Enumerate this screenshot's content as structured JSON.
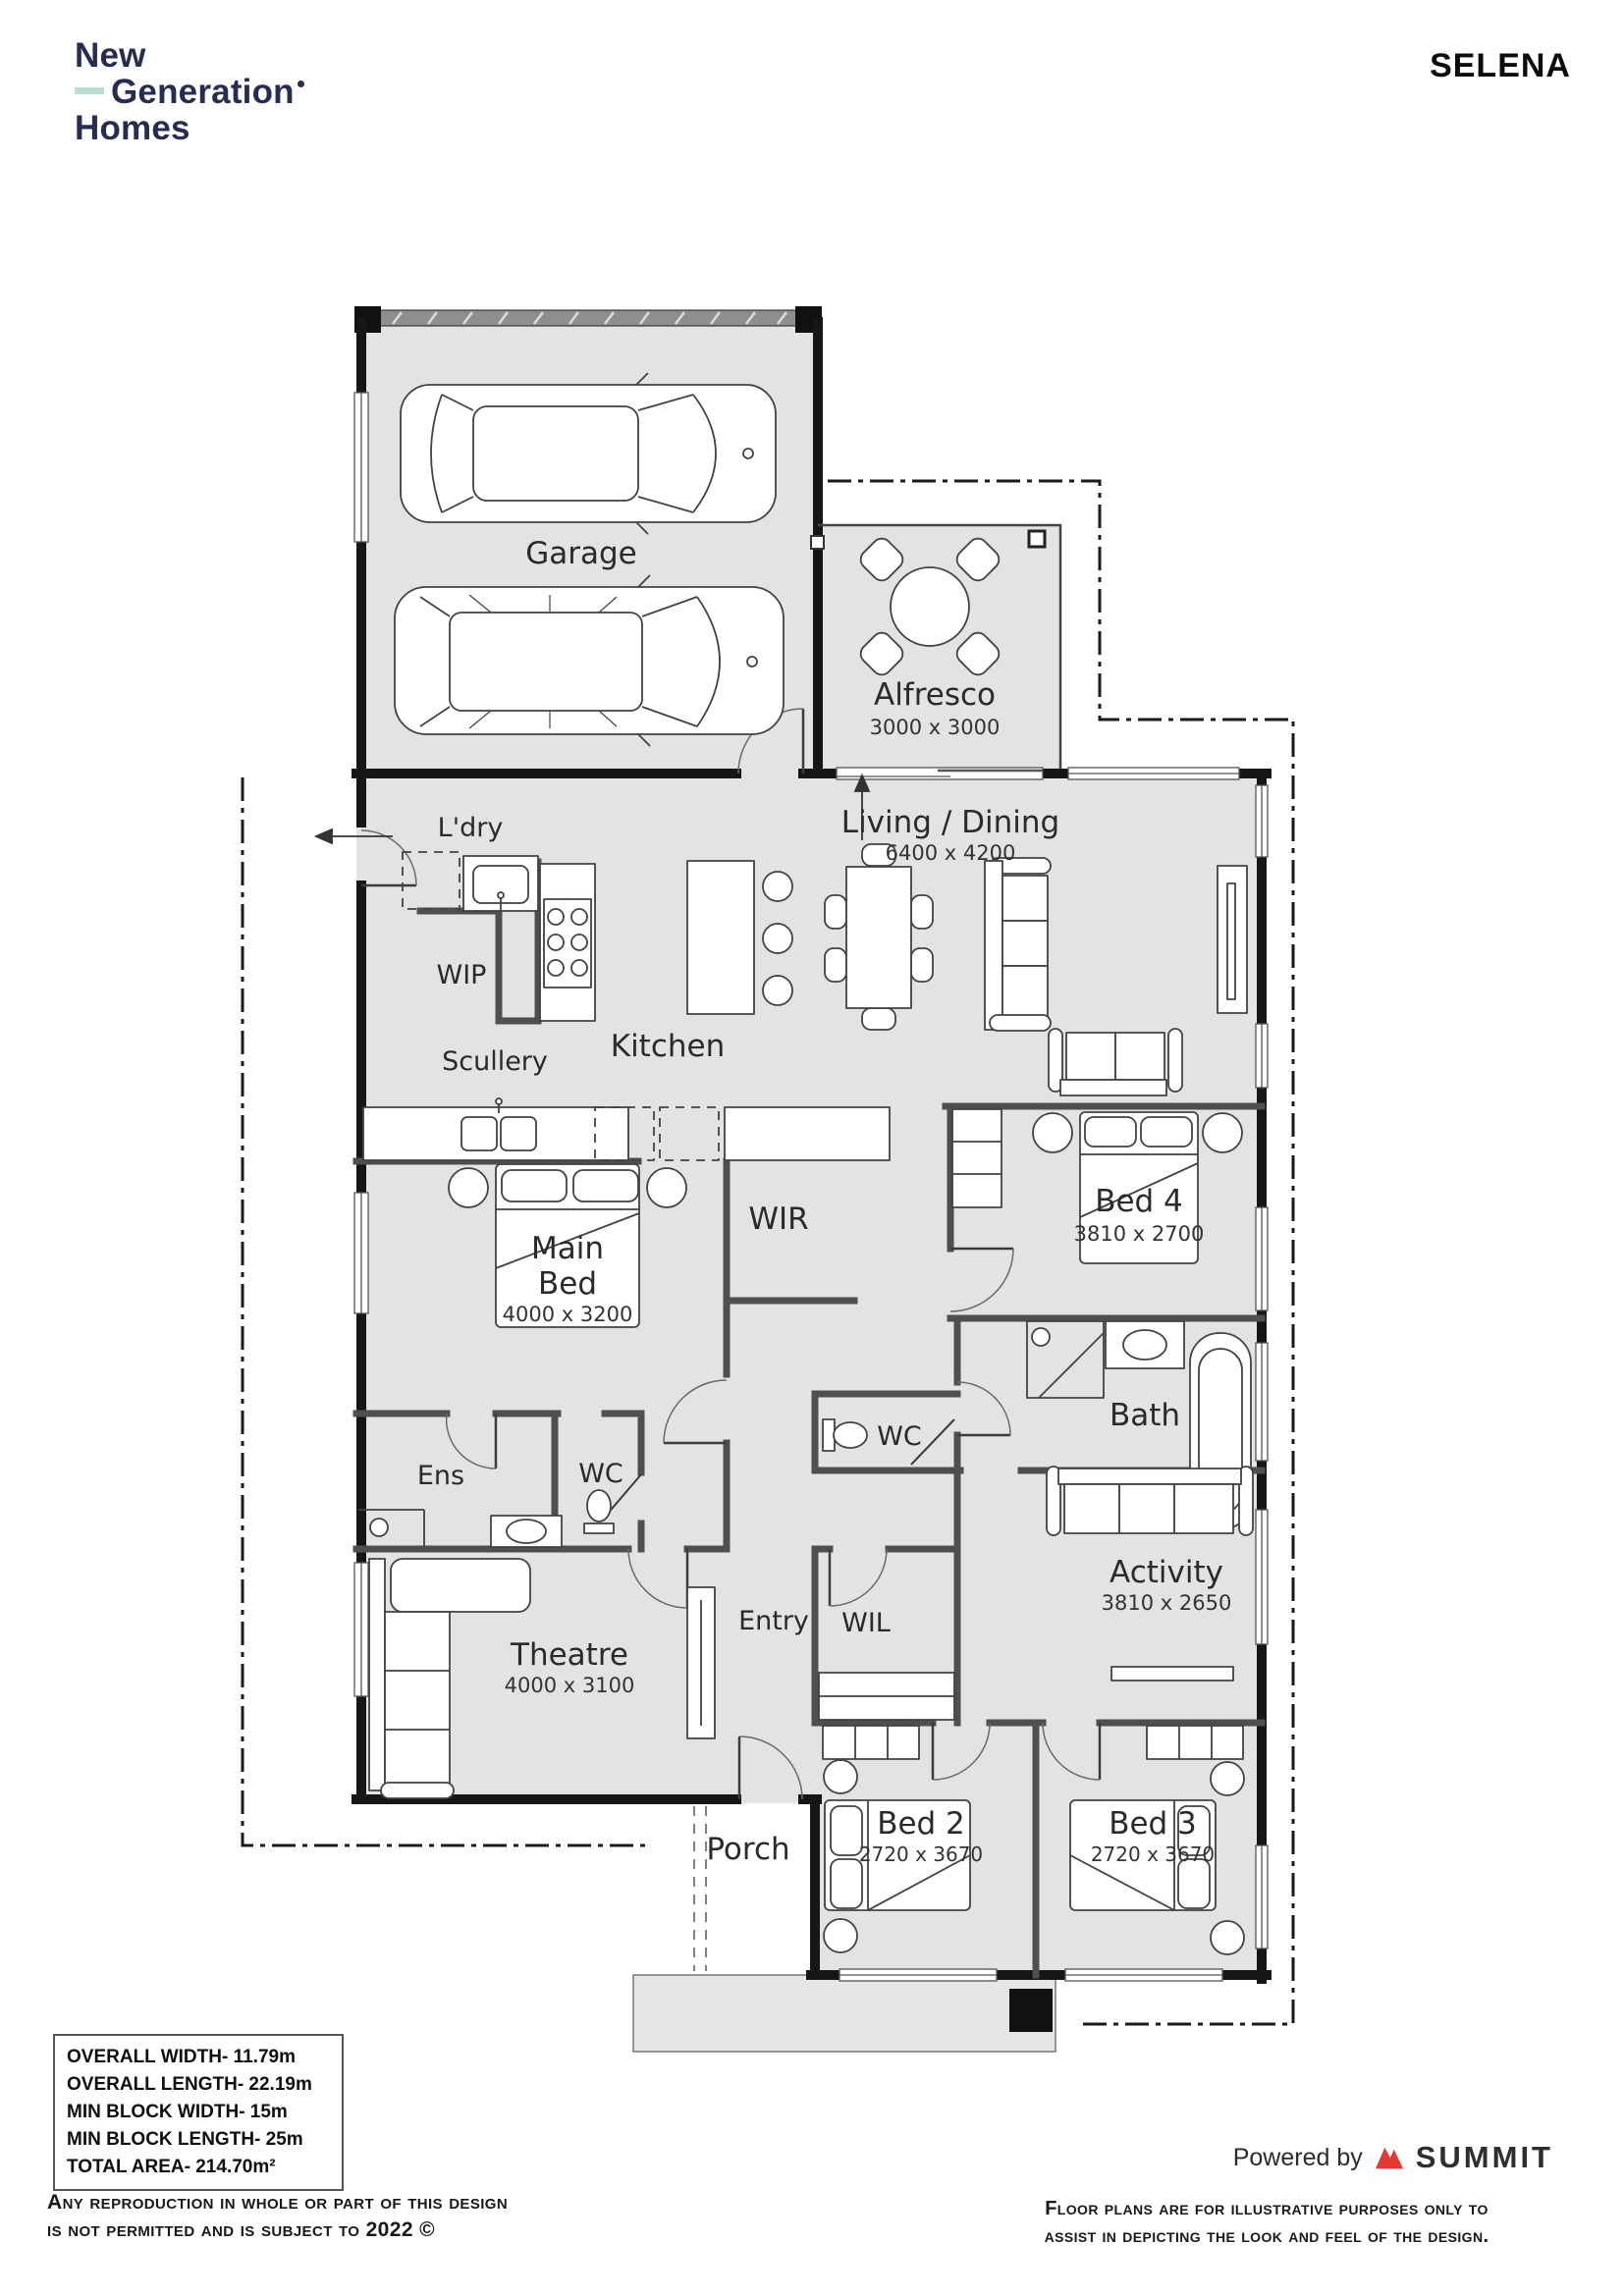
{
  "header": {
    "brand": {
      "line1": "New",
      "line2": "Generation",
      "line3": "Homes"
    },
    "plan_name": "SELENA"
  },
  "plan": {
    "rooms": {
      "garage": {
        "name": "Garage"
      },
      "alfresco": {
        "name": "Alfresco",
        "dims": "3000 x 3000"
      },
      "ldry": {
        "name": "L'dry"
      },
      "living_dining": {
        "name": "Living / Dining",
        "dims": "6400 x 4200"
      },
      "wip": {
        "name": "WIP"
      },
      "scullery": {
        "name": "Scullery"
      },
      "kitchen": {
        "name": "Kitchen"
      },
      "main_bed": {
        "line1": "Main",
        "line2": "Bed",
        "dims": "4000 x 3200"
      },
      "wir": {
        "name": "WIR"
      },
      "bed4": {
        "name": "Bed 4",
        "dims": "3810 x 2700"
      },
      "bath": {
        "name": "Bath"
      },
      "wc_bath": {
        "name": "WC"
      },
      "ens": {
        "name": "Ens"
      },
      "wc_main": {
        "name": "WC"
      },
      "activity": {
        "name": "Activity",
        "dims": "3810 x 2650"
      },
      "theatre": {
        "name": "Theatre",
        "dims": "4000 x 3100"
      },
      "entry": {
        "name": "Entry"
      },
      "wil": {
        "name": "WIL"
      },
      "porch": {
        "name": "Porch"
      },
      "bed2": {
        "name": "Bed 2",
        "dims": "2720 x 3670"
      },
      "bed3": {
        "name": "Bed 3",
        "dims": "2720 x 3670"
      }
    }
  },
  "specs": {
    "overall_width": "OVERALL WIDTH- 11.79m",
    "overall_length": "OVERALL LENGTH- 22.19m",
    "min_block_width": "MIN BLOCK WIDTH- 15m",
    "min_block_length": "MIN BLOCK LENGTH- 25m",
    "total_area": "TOTAL AREA- 214.70m²"
  },
  "footer": {
    "copyright_line1": "Any reproduction in whole or part of this design",
    "copyright_line2": "is not permitted and is subject to 2022 ©",
    "powered_by": "Powered by",
    "summit": "SUMMIT",
    "disclaimer_line1": "Floor plans are for illustrative purposes only to",
    "disclaimer_line2": "assist in depicting the look and feel of the design."
  },
  "colors": {
    "brand_navy": "#252e50",
    "brand_mint": "#b9ded2",
    "summit_red": "#e23a32",
    "floor_fill": "#e3e3e3",
    "wall_black": "#161616",
    "wall_gray": "#4f4f4f"
  }
}
